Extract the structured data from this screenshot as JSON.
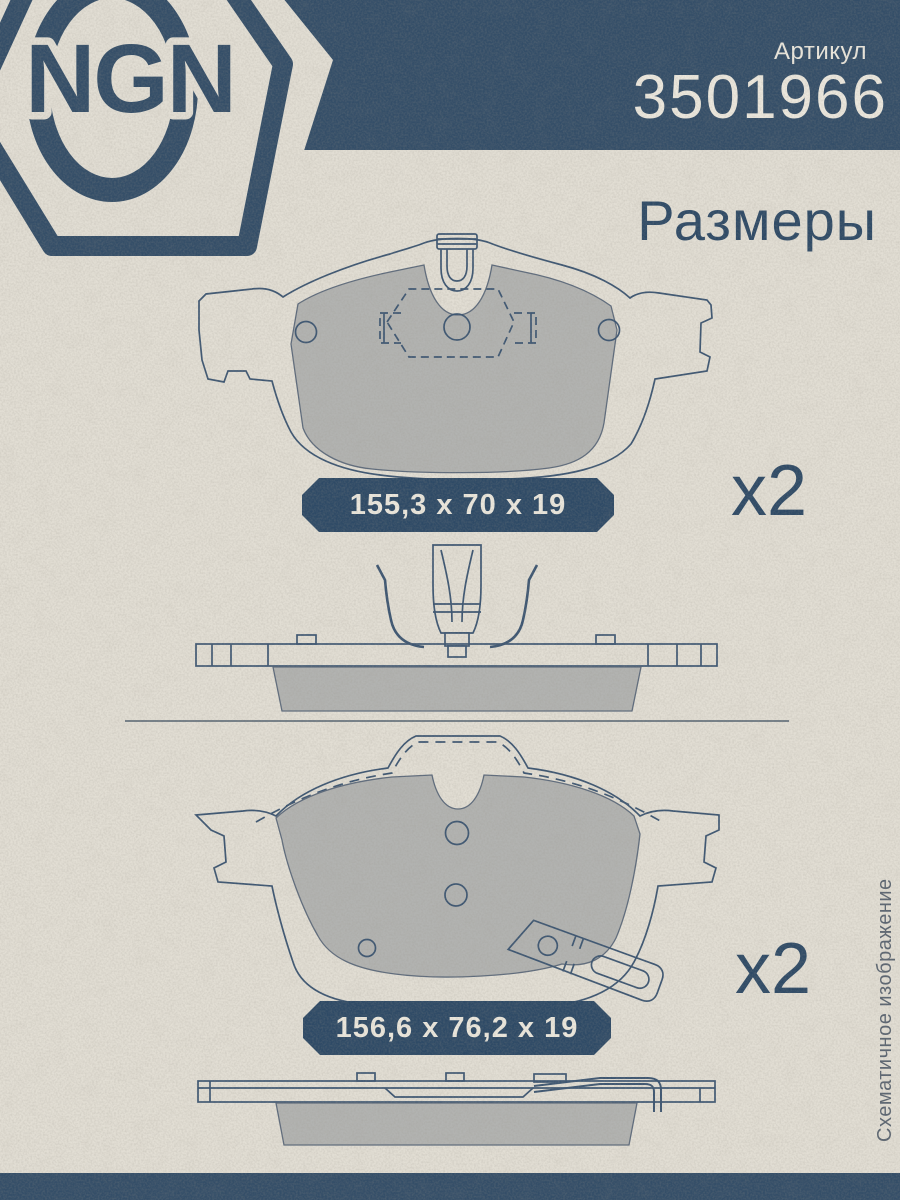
{
  "header": {
    "brand": "NGN",
    "article_label": "Артикул",
    "article_number": "3501966",
    "section_title": "Размеры"
  },
  "pads": [
    {
      "dimensions": "155,3 x 70 x 19",
      "quantity": "x2"
    },
    {
      "dimensions": "156,6 x 76,2 x 19",
      "quantity": "x2"
    }
  ],
  "footnote": "Схематичное изображение",
  "colors": {
    "paper": "#e2ded4",
    "navy_band": "#344e68",
    "navy_pill": "#2e4a66",
    "drawing_line": "#3d5672",
    "friction_gray": "#b2b3b1",
    "cream_text": "#ece8de",
    "footnote_gray": "#5b6571"
  }
}
